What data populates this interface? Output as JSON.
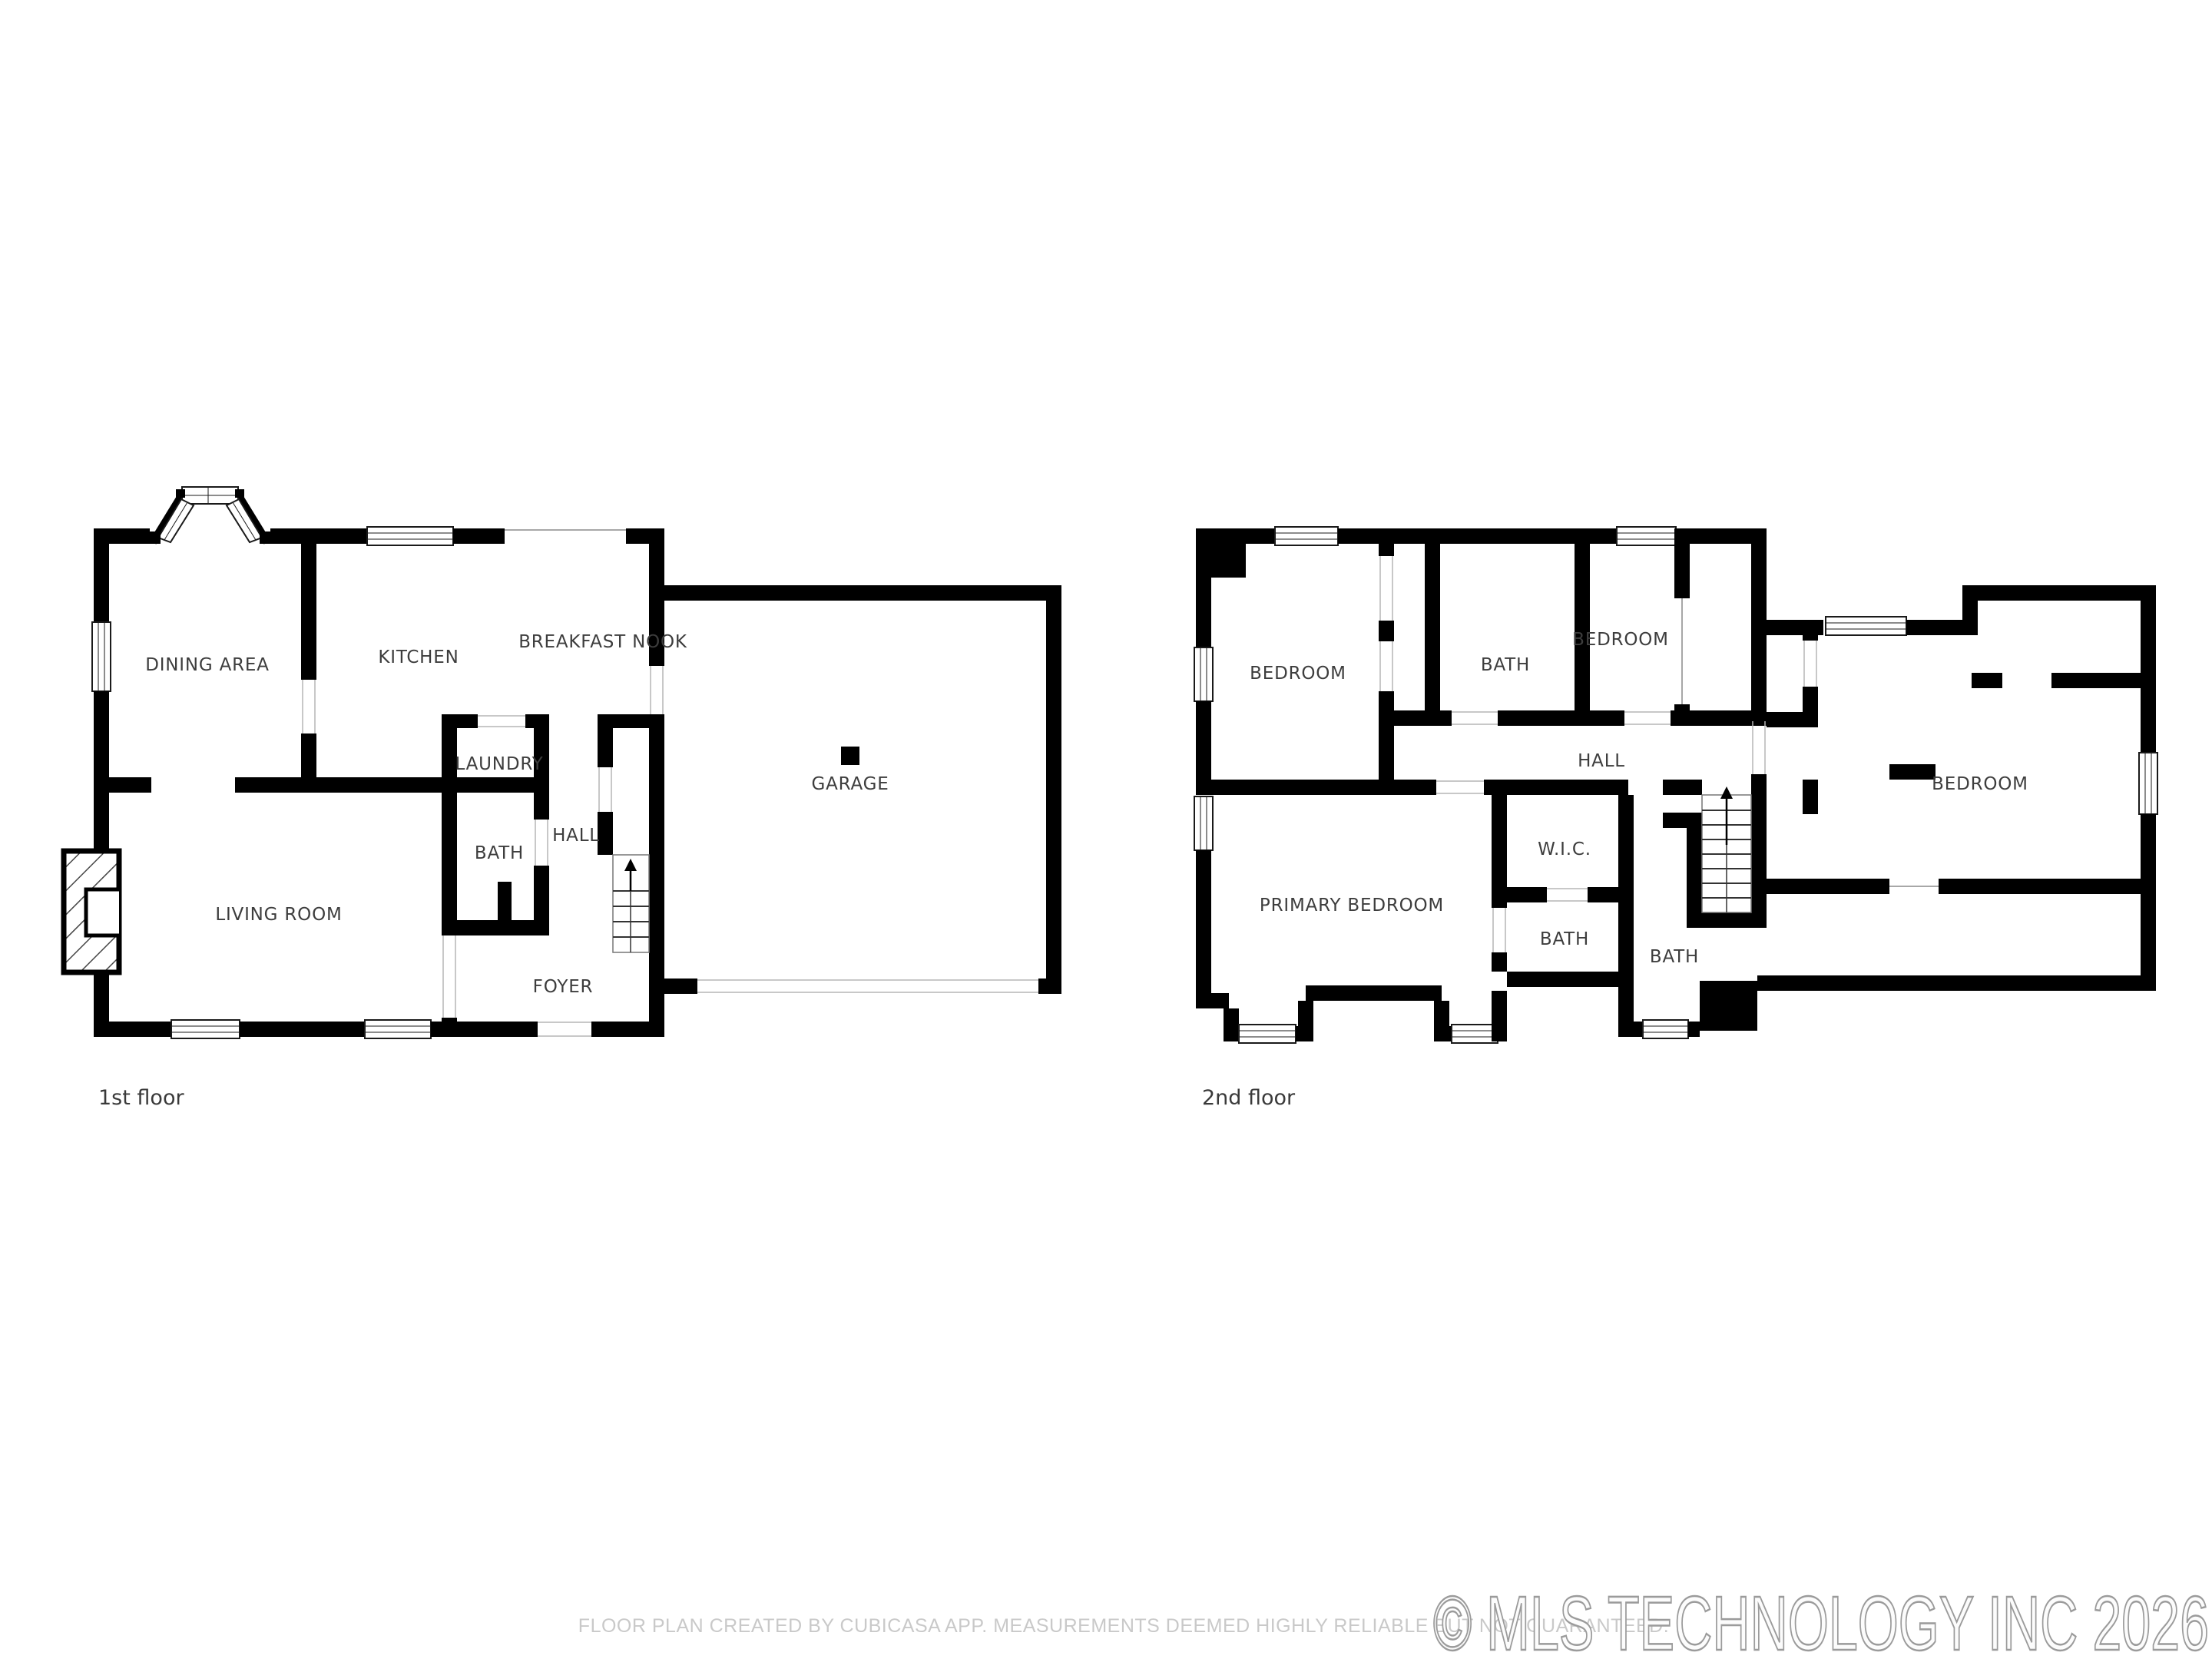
{
  "floor1": {
    "label": "1st floor",
    "rooms": {
      "dining": "DINING AREA",
      "kitchen": "KITCHEN",
      "breakfast_nook": "BREAKFAST NOOK",
      "laundry": "LAUNDRY",
      "bath": "BATH",
      "hall": "HALL",
      "living": "LIVING ROOM",
      "foyer": "FOYER",
      "garage": "GARAGE"
    }
  },
  "floor2": {
    "label": "2nd floor",
    "rooms": {
      "bedroom_nw": "BEDROOM",
      "bath_top": "BATH",
      "bedroom_n": "BEDROOM",
      "hall": "HALL",
      "wic": "W.I.C.",
      "primary": "PRIMARY BEDROOM",
      "bath_left": "BATH",
      "bath_mid": "BATH",
      "bedroom_e": "BEDROOM"
    }
  },
  "footer": {
    "disclaimer": "FLOOR PLAN CREATED BY CUBICASA APP. MEASUREMENTS DEEMED HIGHLY RELIABLE BUT NOT GUARANTEED.",
    "watermark": "© MLS TECHNOLOGY INC 2026"
  },
  "colors": {
    "wall": "#000000",
    "room_label": "#3d3d3d",
    "disclaimer": "#c9c9c9",
    "watermark_stroke": "#9b9b9b",
    "background": "#ffffff"
  }
}
